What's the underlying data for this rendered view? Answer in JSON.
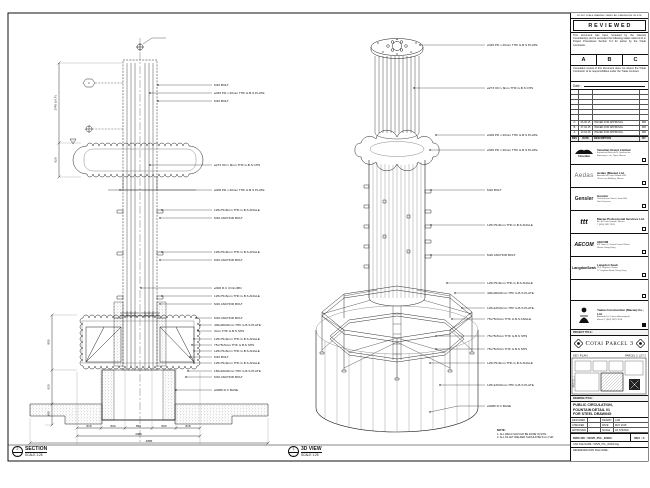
{
  "theme": {
    "ink": "#1a1a1a",
    "paper": "#ffffff",
    "muted": "#555555"
  },
  "sheet": {
    "edge_note": "DO NOT SCALE DRAWING. VERIFY ALL DIMENSIONS ON SITE.",
    "note": {
      "heading": "NOTE:",
      "items": [
        "1. ALL WELD SHOULD BE DONE IN SITE.",
        "2. ALL FILLET WELDED SHOULD BE 6mm THK."
      ]
    }
  },
  "section_view": {
    "tag_num": "2",
    "tag_ref": "-",
    "title": "SECTION",
    "scale": "SCALE 1:25",
    "flag1": "1",
    "flag2": "2",
    "callouts": [
      "M16 BOLT",
      "ø345 PD x 20mm THK G.B.S PLATE",
      "M16 BOLT",
      "ø273 OD x 8mm THK G.B.S CHS",
      "ø406 PD x 20mm THK G.B.S PLATE",
      "125x75x6mm THK G.B.S ANGLE",
      "M16 ANCHOR BOLT",
      "125x75x6mm THK G.B.S ANGLE",
      "M16 ANCHOR BOLT",
      "ø300 R.C COLUMN",
      "125x75x6mm THK G.B.S ANGLE",
      "M16 ANCHOR BOLT",
      "M16 ANCHOR BOLT",
      "400x200x8mm THK G.B.S PLATE",
      "3mm THK G.B.S SHS",
      "125x75x6mm THK G.B.S ANGLE",
      "75x75x5mm THK G.B.S SHS",
      "125x75x6mm THK G.B.S ANGLE",
      "M16 BOLT",
      "125x75x6mm THK G.B.S ANGLE",
      "150x100x8mm THK G.B.S PLATE",
      "M16 ANCHOR BOLT",
      "ø4086 R.C BASE"
    ],
    "dims_left": [
      "1740 (V.I.F)",
      "620",
      "855",
      "620",
      "380"
    ],
    "dims_bottom": [
      "818",
      "800",
      "850",
      "800",
      "818"
    ],
    "dim_total": "4086",
    "dim_overall": "4886"
  },
  "iso_view": {
    "tag_num": "3",
    "tag_ref": "-",
    "title": "3D VIEW",
    "scale": "SCALE 1:25",
    "callouts": [
      "ø345 PD x 20mm THK G.B.S PLATE",
      "ø273 OD x 8mm THK G.B.S CHS",
      "ø406 PD x 20mm THK G.B.S PLATE",
      "ø345 PD x 20mm THK G.B.S PLATE",
      "M16 BOLT",
      "125x75x6mm THK G.B.S ANGLE",
      "M16 ANCHOR BOLT",
      "125x75x6mm THK G.B.S ANGLE",
      "400x200x8mm THK G.B.S PLATE",
      "125x125x6mm THK G.B.S PLATE",
      "75x75x6mm THK G.B.S ANGLE",
      "75x75x5mm THK G.B.S SHS",
      "75x75x5mm THK G.B.S SHS",
      "125x75x6mm THK G.B.S ANGLE",
      "125x125x6mm THK G.B.S PLATE",
      "ø4086 R.C BASE"
    ]
  },
  "title_block": {
    "review_stamp": {
      "title": "R E V I E W E D",
      "para1": "This document has been reviewed by the relevant Consultant(s) and is accorded the following status referred to in Project Procedures Section 5.4 for action by the Trade Contractor.",
      "statuses": [
        "A",
        "B",
        "C"
      ],
      "para2": "Consultant review of this document does not relieve the Trade Contractor of its responsibilities under the Trade Contract.",
      "date_label": "Date :"
    },
    "revision_table": {
      "headers": [
        "REV",
        "DATE",
        "DESCRIPTION",
        "BY"
      ],
      "rows": [
        {
          "rev": "C",
          "date": "06.05.15",
          "desc": "ISSUED FOR APPROVAL",
          "by": "WD"
        },
        {
          "rev": "B",
          "date": "27.04.15",
          "desc": "ISSUED FOR APPROVAL",
          "by": "WD"
        },
        {
          "rev": "A",
          "date": "13.04.15",
          "desc": "ISSUED FOR APPROVAL",
          "by": "WD"
        }
      ]
    },
    "consultants": [
      {
        "logo_text": "Venetian",
        "name": "Venetian Orient Limited",
        "addr1": "Estrada da Baía de N. Senhora da",
        "addr2": "Esperança, s/n, Taipa, Macau"
      },
      {
        "logo_text": "Aedas",
        "name": "Aedas (Macau) Ltd.",
        "addr1": "Avenida da Praia Grande 409,",
        "addr2": "China Law Building, Macau"
      },
      {
        "logo_text": "Gensler",
        "name": "Gensler",
        "addr1": "Two Harrison Street, Suite 400,",
        "addr2": "San Francisco"
      },
      {
        "logo_text": "ttt",
        "name": "Macau Professional Services Ltd.",
        "addr1": "Av. da Praia Grande, Macau",
        "addr2": "T (853) 2837 2623"
      },
      {
        "logo_text": "AECOM",
        "name": "AECOM",
        "addr1": "8/F Tower 2, Grand Central Plaza,",
        "addr2": "Shatin, Hong Kong"
      },
      {
        "logo_text": "LangdonSeah",
        "name": "Langdon Seah",
        "addr1": "21/F Leighton Centre,",
        "addr2": "77 Leighton Road, Hong Kong"
      }
    ],
    "contractor": {
      "name": "Yadea Construction (Macau) Co., Ltd.",
      "addr1": "Alameda Dr. Carlos d'Assumpção,",
      "addr2": "Macau   T (853) 2875 3218"
    },
    "project": {
      "bar": "PROJECT TITLE :",
      "name": "Cotai Parcel 3"
    },
    "key_plan": {
      "label": "KEY PLAN",
      "parcel": "PARCEL 3, LOT 2",
      "side_label": "PARCEL 1"
    },
    "drawing": {
      "bar": "DRAWING TITLE :",
      "title_lines": [
        "PUBLIC CIRCULATION,",
        "FOUNTAIN DETAIL 01",
        "FOR STEEL DRAWING"
      ],
      "meta": {
        "designed_label": "DESIGNED",
        "designed": "-",
        "drawn_label": "DRAWN",
        "drawn": "LAM",
        "checked_label": "CHECKED",
        "checked": "-",
        "date_label": "DATE",
        "date": "MAY 2015",
        "approved_label": "APPROVED",
        "approved": "-",
        "scale_label": "SCALE",
        "scale": "AS SHOWN"
      },
      "dwg_no_label": "DWG NO :",
      "dwg_no": "51525_PCL_00303",
      "rev_label": "REV :",
      "rev": "C",
      "cad_label": "CAD FILE NAME :",
      "cad": "51525_PCL_00303.dwg",
      "ref_label": "REFERENCE DWG FILE NAME :"
    }
  }
}
